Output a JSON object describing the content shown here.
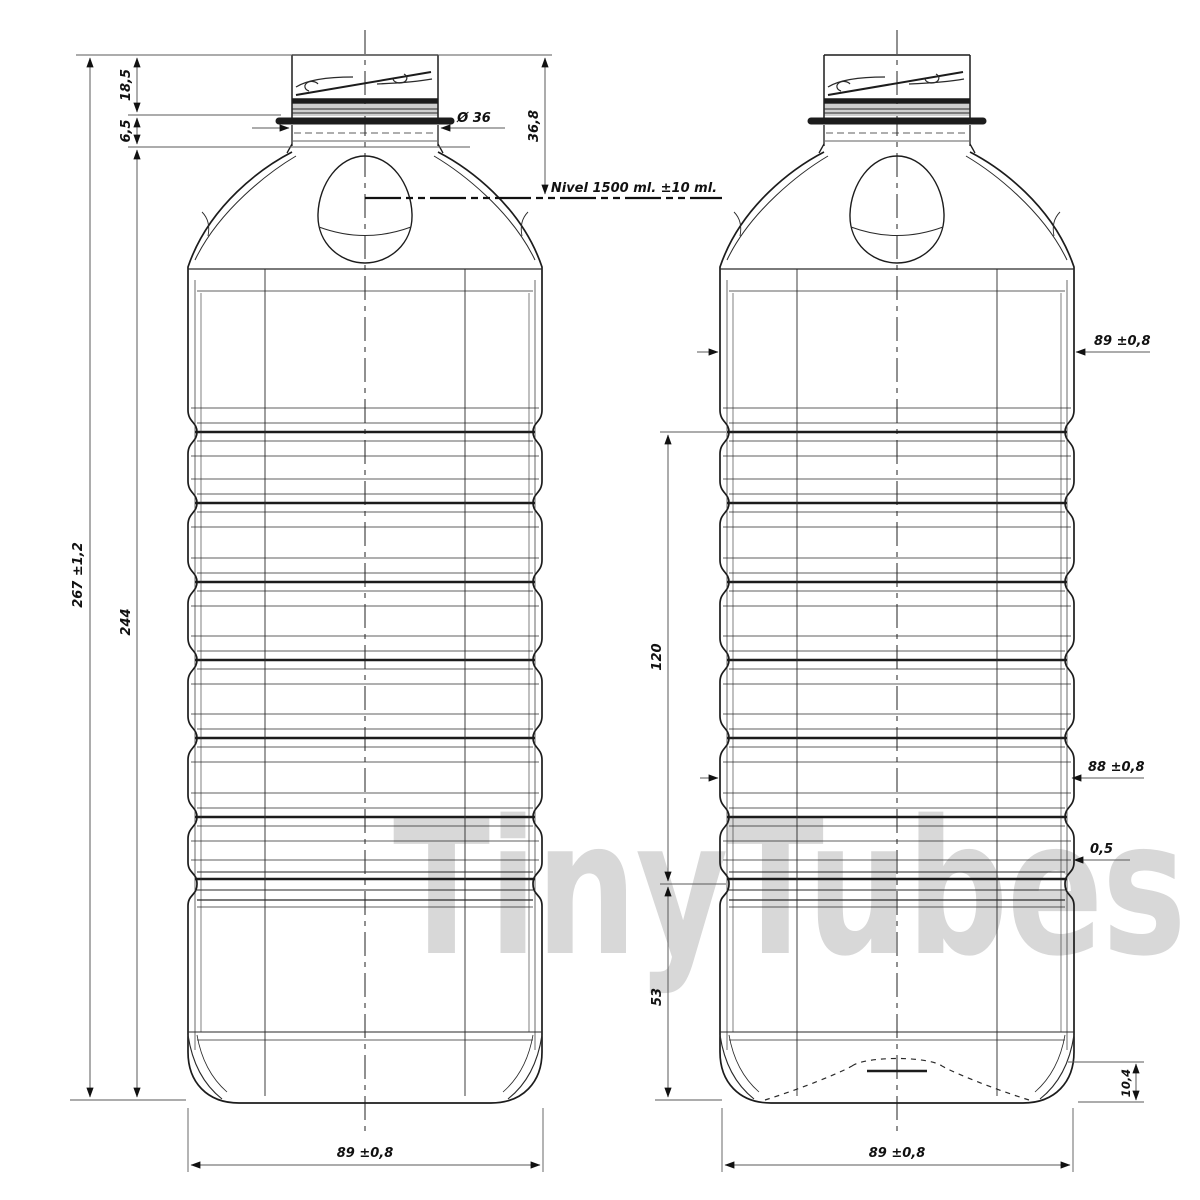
{
  "watermark": "TinyTubes",
  "colors": {
    "line": "#1c1c1c",
    "dimension_line": "#5a5a5a",
    "text": "#111111",
    "watermark": "#d8d8d8",
    "background": "#ffffff"
  },
  "front_view": {
    "name": "front-view",
    "dimensions": {
      "overall_height": "267 ±1,2",
      "body_height": "244",
      "neck_finish_height": "18,5",
      "support_ring_offset": "6,5",
      "neck_diameter": "Ø 36",
      "fill_level_depth": "36,8",
      "fill_level_note": "Nivel 1500 ml. ±10 ml.",
      "base_width": "89 ±0,8"
    }
  },
  "side_view": {
    "name": "side-view",
    "dimensions": {
      "body_width": "89 ±0,8",
      "ribbed_section_height": "120",
      "rib_waist_width": "88 ±0,8",
      "rib_step_depth": "0,5",
      "lower_section_height": "53",
      "base_pushup_height": "10,4",
      "base_width": "89 ±0,8"
    }
  }
}
